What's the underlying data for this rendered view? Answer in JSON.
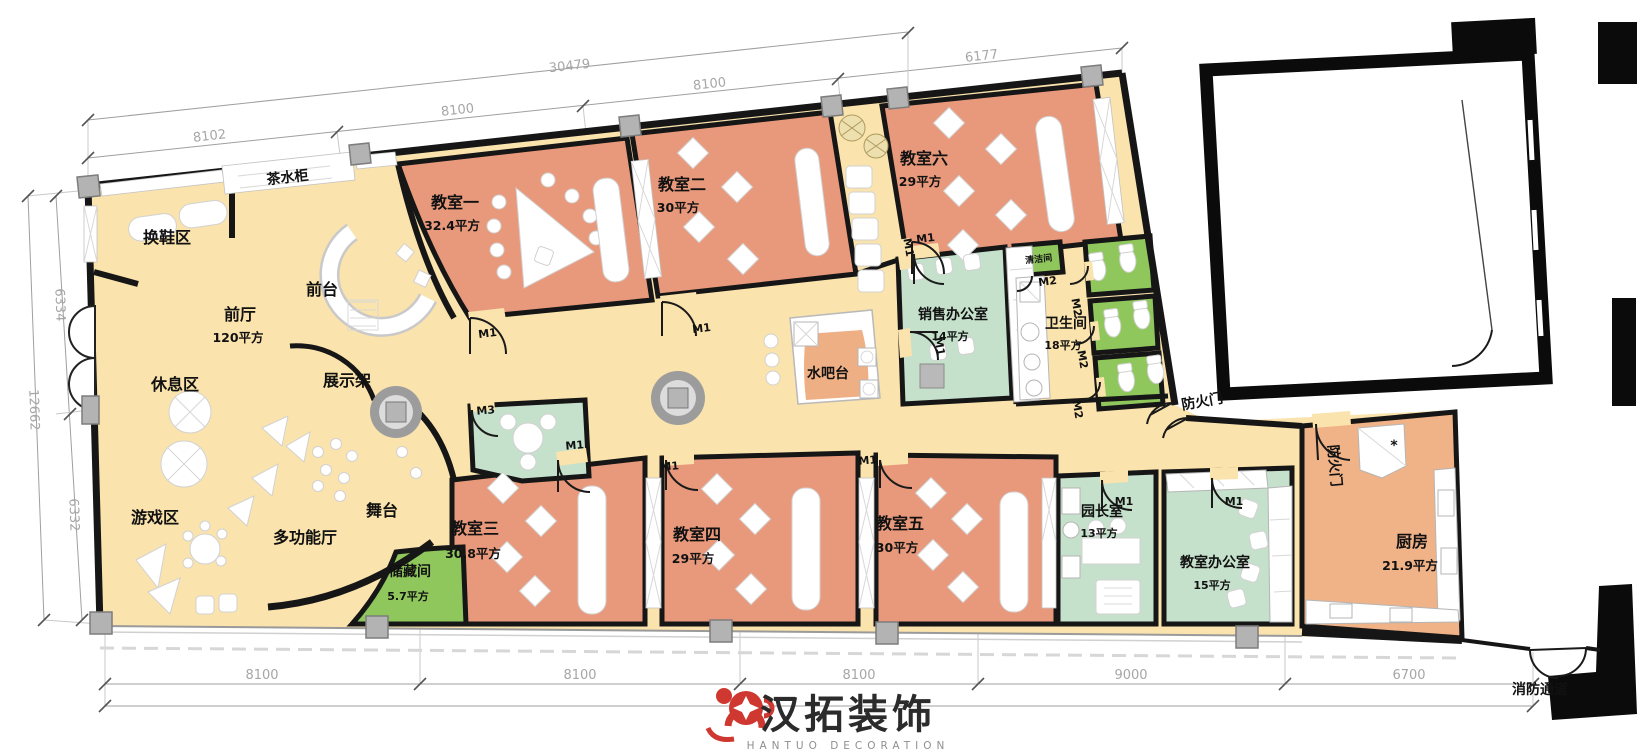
{
  "rooms": {
    "huanxie": {
      "name": "换鞋区"
    },
    "chashui": {
      "name": "茶水柜"
    },
    "qiantai": {
      "name": "前台"
    },
    "qianting": {
      "name": "前厅",
      "area": "120平方"
    },
    "xiuxi": {
      "name": "休息区"
    },
    "zhanshijia": {
      "name": "展示架"
    },
    "youxi": {
      "name": "游戏区"
    },
    "duogongneng": {
      "name": "多功能厅"
    },
    "wutai": {
      "name": "舞台"
    },
    "chucang": {
      "name": "储藏间",
      "area": "5.7平方"
    },
    "cls1": {
      "name": "教室一",
      "area": "32.4平方"
    },
    "cls2": {
      "name": "教室二",
      "area": "30平方"
    },
    "cls3": {
      "name": "教室三",
      "area": "30.8平方"
    },
    "cls4": {
      "name": "教室四",
      "area": "29平方"
    },
    "cls5": {
      "name": "教室五",
      "area": "30平方"
    },
    "cls6": {
      "name": "教室六",
      "area": "29平方"
    },
    "xiaoshou": {
      "name": "销售办公室",
      "area": "14平方"
    },
    "qingjie": {
      "name": "清洁间"
    },
    "weisheng": {
      "name": "卫生间",
      "area": "18平方"
    },
    "shuiba": {
      "name": "水吧台"
    },
    "yuanzhang": {
      "name": "园长室",
      "area": "13平方"
    },
    "jiaoshiban": {
      "name": "教室办公室",
      "area": "15平方"
    },
    "chufang": {
      "name": "厨房",
      "area": "21.9平方"
    }
  },
  "labels": {
    "fire_door": "防火门",
    "fire_exit": "消防通道",
    "star": "*"
  },
  "doors": {
    "m1": "M1",
    "m2": "M2",
    "m3": "M3"
  },
  "dimensions": {
    "top": [
      "8102",
      "8100",
      "8100",
      "6177",
      "30479"
    ],
    "bottom": [
      "8100",
      "8100",
      "8100",
      "9000",
      "6700"
    ],
    "left": [
      "6334",
      "6332",
      "12662"
    ]
  },
  "logo": {
    "cn": "汉拓装饰",
    "en": "HANTUO DECORATION"
  },
  "colors": {
    "hall": "#FAE3AC",
    "classroom": "#E8997B",
    "office": "#C5E0CB",
    "green": "#8FC75D",
    "kitchen": "#F0B287",
    "bar": "#EFAF85",
    "deco": "#EDE0AE",
    "wall": "#161616",
    "dim": "#A6A6A6",
    "logo_red": "#CE3830",
    "column": "#B3B3B3"
  }
}
